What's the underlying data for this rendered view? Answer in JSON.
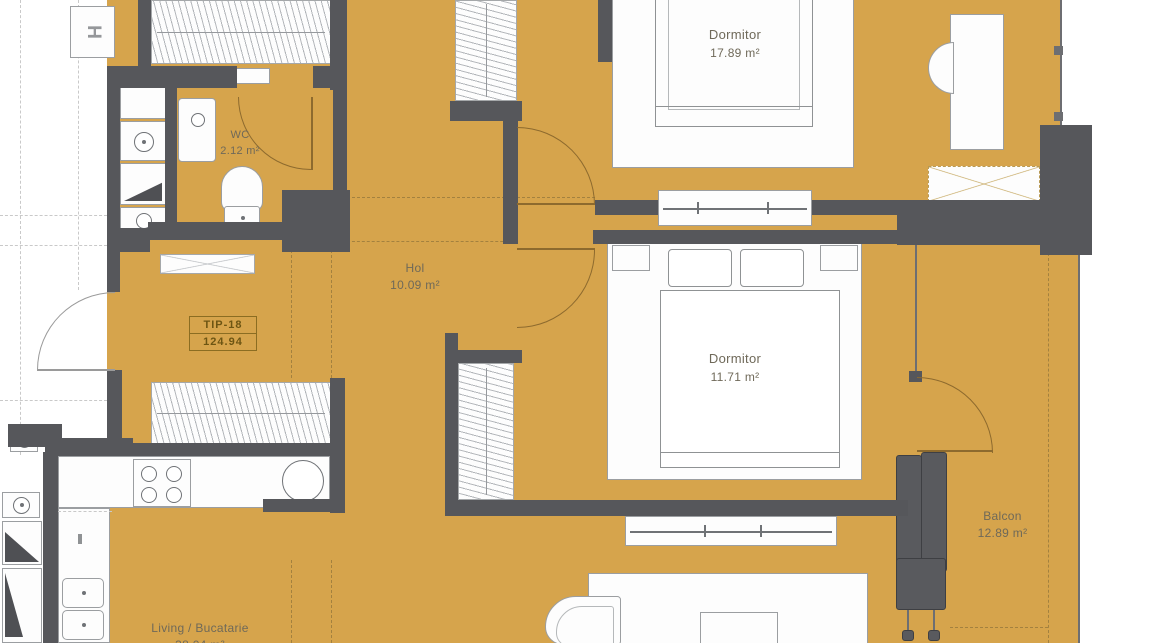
{
  "unit": {
    "type": "TIP-18",
    "total_area": "124.94"
  },
  "rooms": {
    "dormitor1": {
      "name": "Dormitor",
      "area": "17.89 m²"
    },
    "dormitor2": {
      "name": "Dormitor",
      "area": "11.71 m²"
    },
    "wc": {
      "name": "WC",
      "area": "2.12 m²"
    },
    "hol": {
      "name": "Hol",
      "area": "10.09 m²"
    },
    "balcon": {
      "name": "Balcon",
      "area": "12.89 m²"
    },
    "living": {
      "name": "Living / Bucatarie",
      "area": "38.04 m²"
    }
  },
  "corridor": {
    "elevator_label": "H"
  },
  "colors": {
    "floor": "#D6A44C",
    "wall": "#56575B",
    "furniture_outline": "#9b9ea1",
    "door_arc": "#8d6a2e",
    "label_text": "#6f6959",
    "tip_box": "#8b6d22"
  },
  "fixtures": [
    "bed-double",
    "bed-double",
    "wardrobe",
    "wc-toilet",
    "wc-sink",
    "kitchen-stove",
    "kitchen-sink-round",
    "kitchen-sink-double",
    "washing-machine",
    "sofa",
    "coffee-table",
    "desk-with-chair",
    "radiator-columns"
  ]
}
